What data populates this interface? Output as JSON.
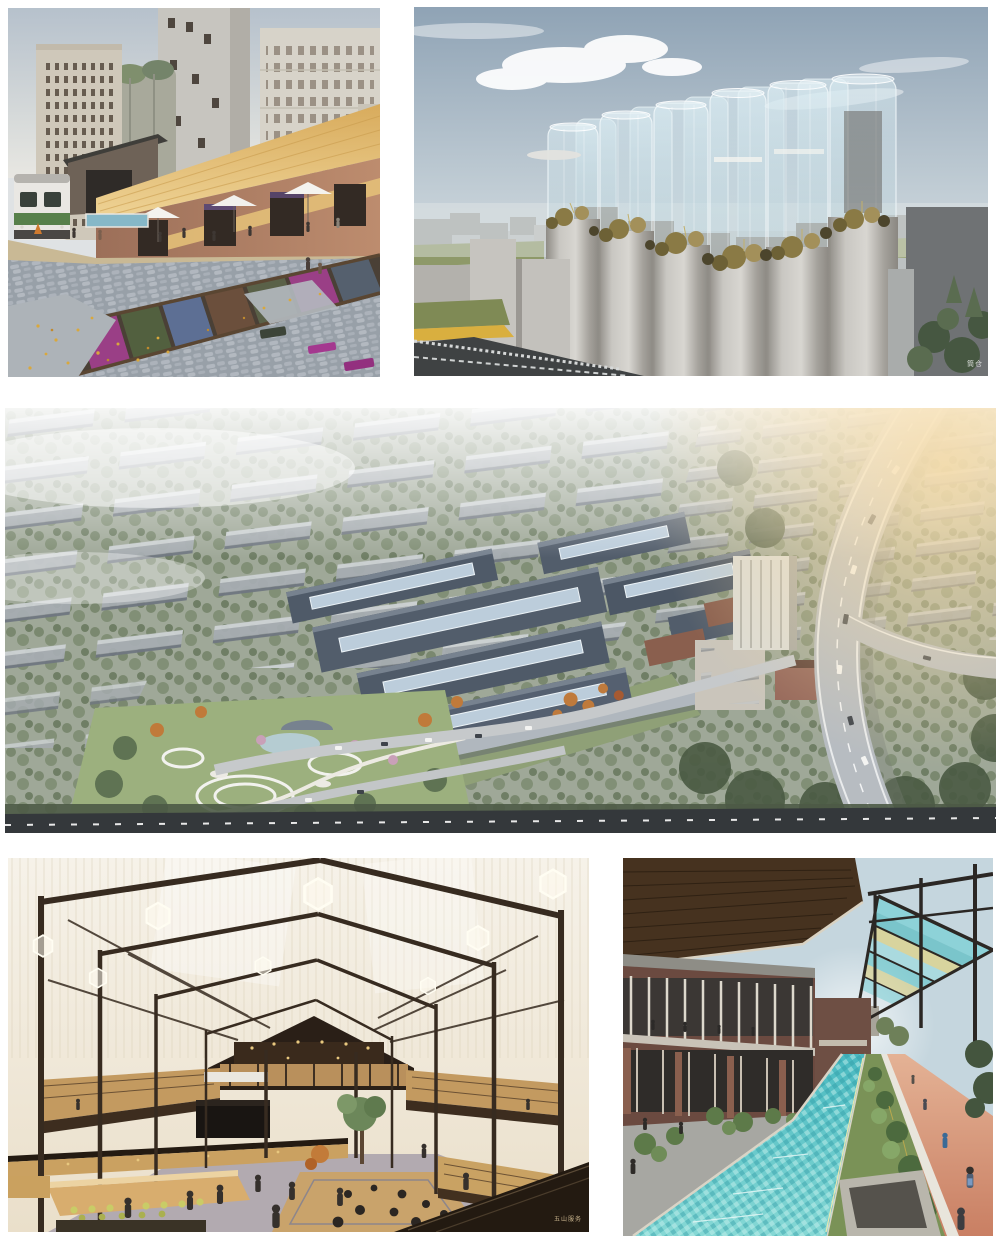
{
  "collage": {
    "background": "#ffffff",
    "images": [
      {
        "id": "img1",
        "alt": "Industrial heritage plaza: white and green train car beside brick warehouses with golden thatched roofs, white umbrellas, concrete silo towers behind, railway track with colored planting beds and fallen yellow leaves",
        "palette": [
          "#b6c1cc",
          "#cfc8ba",
          "#e0b86a",
          "#b4836a",
          "#9aa2ab",
          "#9a3f86"
        ]
      },
      {
        "id": "img2",
        "alt": "Cluster of concrete grain silos crowned by transparent glass cylinders with rooftop shrubs and grasses, grey massing-model city on the horizon",
        "watermark": "筒仓",
        "palette": [
          "#9fb0bf",
          "#d6d4cf",
          "#e9f4f7",
          "#8a7a45",
          "#6f7274"
        ]
      },
      {
        "id": "img3",
        "alt": "Aerial masterplan render: rows of grey slab housing in trees, central factory campus with dark sawtooth roofs and pale blue skylights, white silo building, circular park paths and a curving elevated highway in warm evening light",
        "palette": [
          "#9fa898",
          "#525d6b",
          "#bccddb",
          "#9cb07e",
          "#b7bcc1",
          "#f5d9a8"
        ]
      },
      {
        "id": "img4",
        "alt": "Market hall interior: dark steel portal frames under a translucent ribbed roof with hexagonal pendant lights, timber mezzanines, central tree, sunken lounge and market stalls with people",
        "watermark": "五山服务",
        "palette": [
          "#f3efe6",
          "#372b20",
          "#c39a60",
          "#b2aab0",
          "#6c875a"
        ]
      },
      {
        "id": "img5",
        "alt": "Linear canal promenade: mosaic-tiled turquoise water channel between planted beds, terracotta running track with pedestrians, two-storey brick galleries and a steel pergola with colorful glass panels",
        "palette": [
          "#c5d6de",
          "#46321f",
          "#49b9c0",
          "#7a9257",
          "#cf8f72"
        ]
      }
    ]
  }
}
